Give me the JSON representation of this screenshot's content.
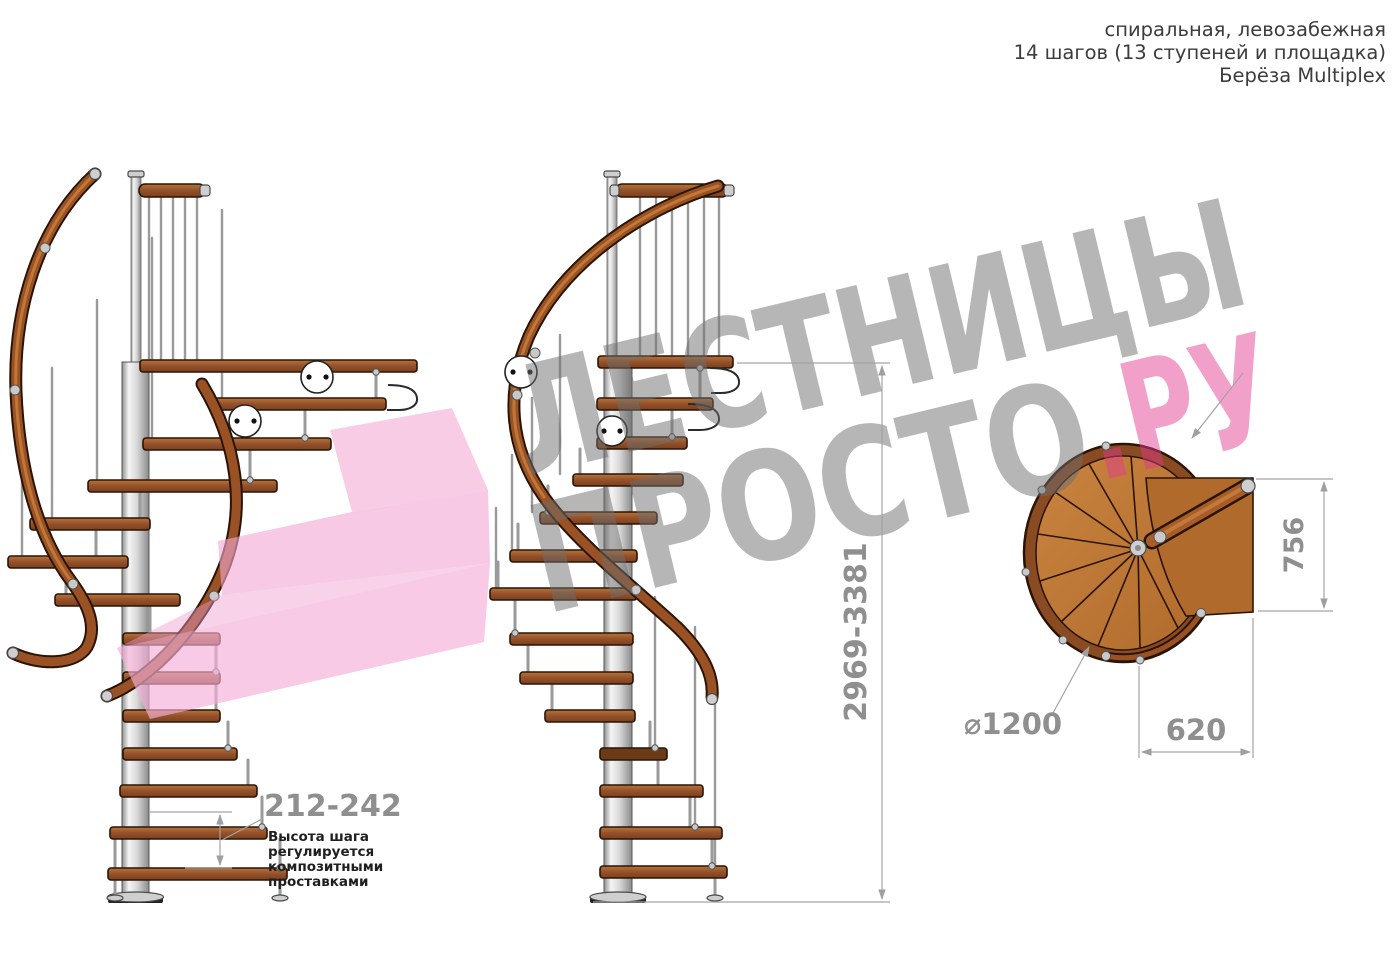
{
  "header": {
    "line1": "спиральная, левозабежная",
    "line2": "14 шагов (13 ступеней и площадка)",
    "line3": "Берёза Multiplex"
  },
  "watermark": {
    "word1": "ЛЕСТНИЦЫ",
    "word2_gray": "ПРОСТО",
    "word2_pink": ".РУ",
    "gray_color": "#9e9e9e",
    "pink_color": "#e23a8e",
    "arrow_pink": "#f2a7d4"
  },
  "dimensions": {
    "total_height": "2969-3381",
    "landing_width": "756",
    "landing_depth": "620",
    "diameter": "⌀1200",
    "step_height": "212-242",
    "step_note_lines": [
      "Высота шага",
      "регулируется",
      "композитными",
      "проставками"
    ]
  },
  "views": {
    "left_elevation": "side view (spiral start)",
    "front_elevation": "side view (landing front)",
    "top_plan": "plan view"
  },
  "colors": {
    "wood_light": "#b5763a",
    "wood_mid": "#94502a",
    "wood_shadow": "#6b3a16",
    "metal_light": "#f2f2f2",
    "metal_mid": "#c0c0c0",
    "dim_gray": "#9a9a9a"
  }
}
